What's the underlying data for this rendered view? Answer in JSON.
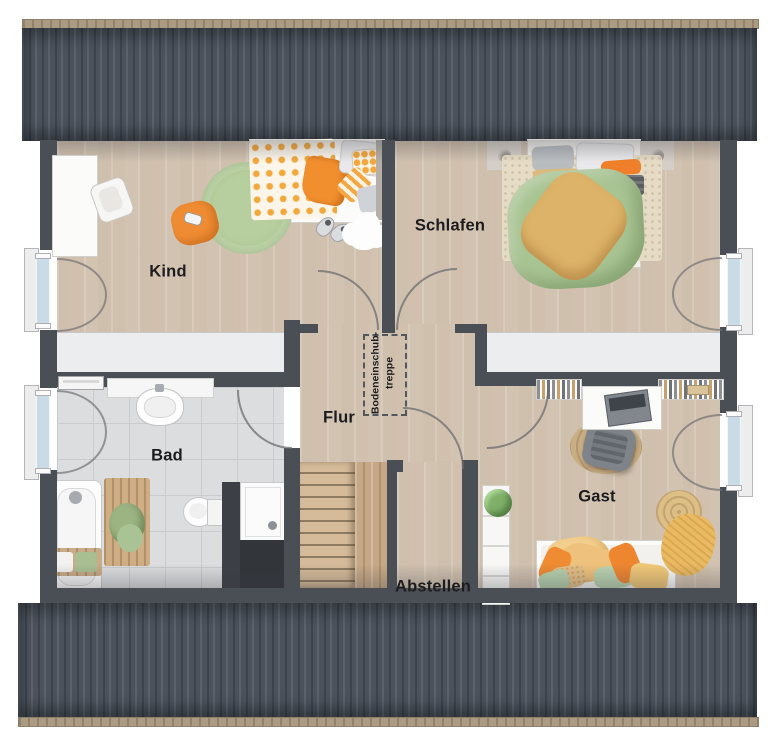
{
  "floorplan": {
    "title": "attic floor plan",
    "rooms": [
      {
        "id": "kind",
        "label": "Kind"
      },
      {
        "id": "schlafen",
        "label": "Schlafen"
      },
      {
        "id": "bad",
        "label": "Bad"
      },
      {
        "id": "flur",
        "label": "Flur"
      },
      {
        "id": "gast",
        "label": "Gast"
      },
      {
        "id": "abstellen",
        "label": "Abstellen"
      }
    ],
    "loft_hatch": {
      "line1": "Bodeneinschub-",
      "line2": "treppe"
    },
    "colors": {
      "wall": "#4a4f56",
      "wood_floor": "#d6c8b7",
      "tile_floor": "#dcdddf",
      "roof": "#49505a",
      "roof_ridge": "#ab9b83",
      "accent_orange": "#ef8c33",
      "accent_green": "#a9c493",
      "window_glass": "#c8dbe7",
      "label_text": "#1c1c1e"
    }
  }
}
